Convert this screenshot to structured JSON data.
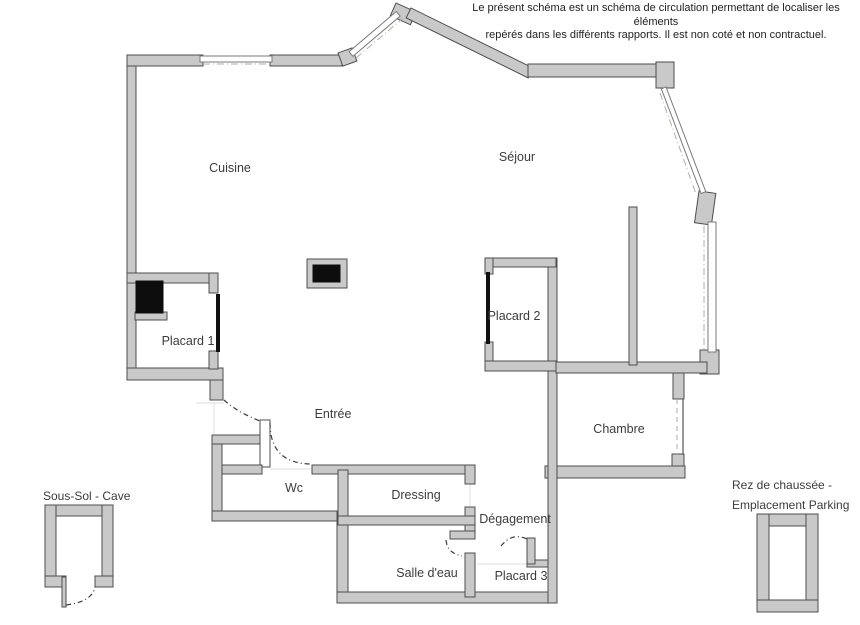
{
  "disclaimer": {
    "line1": "Le présent schéma est un schéma de circulation permettant de localiser les éléments",
    "line2": "repérés dans les différents rapports. Il est non coté et non contractuel."
  },
  "rooms": [
    {
      "id": "cuisine",
      "label": "Cuisine"
    },
    {
      "id": "sejour",
      "label": "Séjour"
    },
    {
      "id": "placard1",
      "label": "Placard 1"
    },
    {
      "id": "placard2",
      "label": "Placard 2"
    },
    {
      "id": "entree",
      "label": "Entrée"
    },
    {
      "id": "chambre",
      "label": "Chambre"
    },
    {
      "id": "wc",
      "label": "Wc"
    },
    {
      "id": "dressing",
      "label": "Dressing"
    },
    {
      "id": "degagement",
      "label": "Dégagement"
    },
    {
      "id": "salle_deau",
      "label": "Salle d'eau"
    },
    {
      "id": "placard3",
      "label": "Placard 3"
    }
  ],
  "annexes": {
    "cave_label": "Sous-Sol - Cave",
    "parking_line1": "Rez de chaussée -",
    "parking_line2": "Emplacement Parking"
  },
  "colors": {
    "wall_fill": "#c9c9c9",
    "wall_stroke": "#4d4d4d",
    "text": "#3c3c3c",
    "door_black": "#111111",
    "window_dash": "#b3ada3"
  }
}
